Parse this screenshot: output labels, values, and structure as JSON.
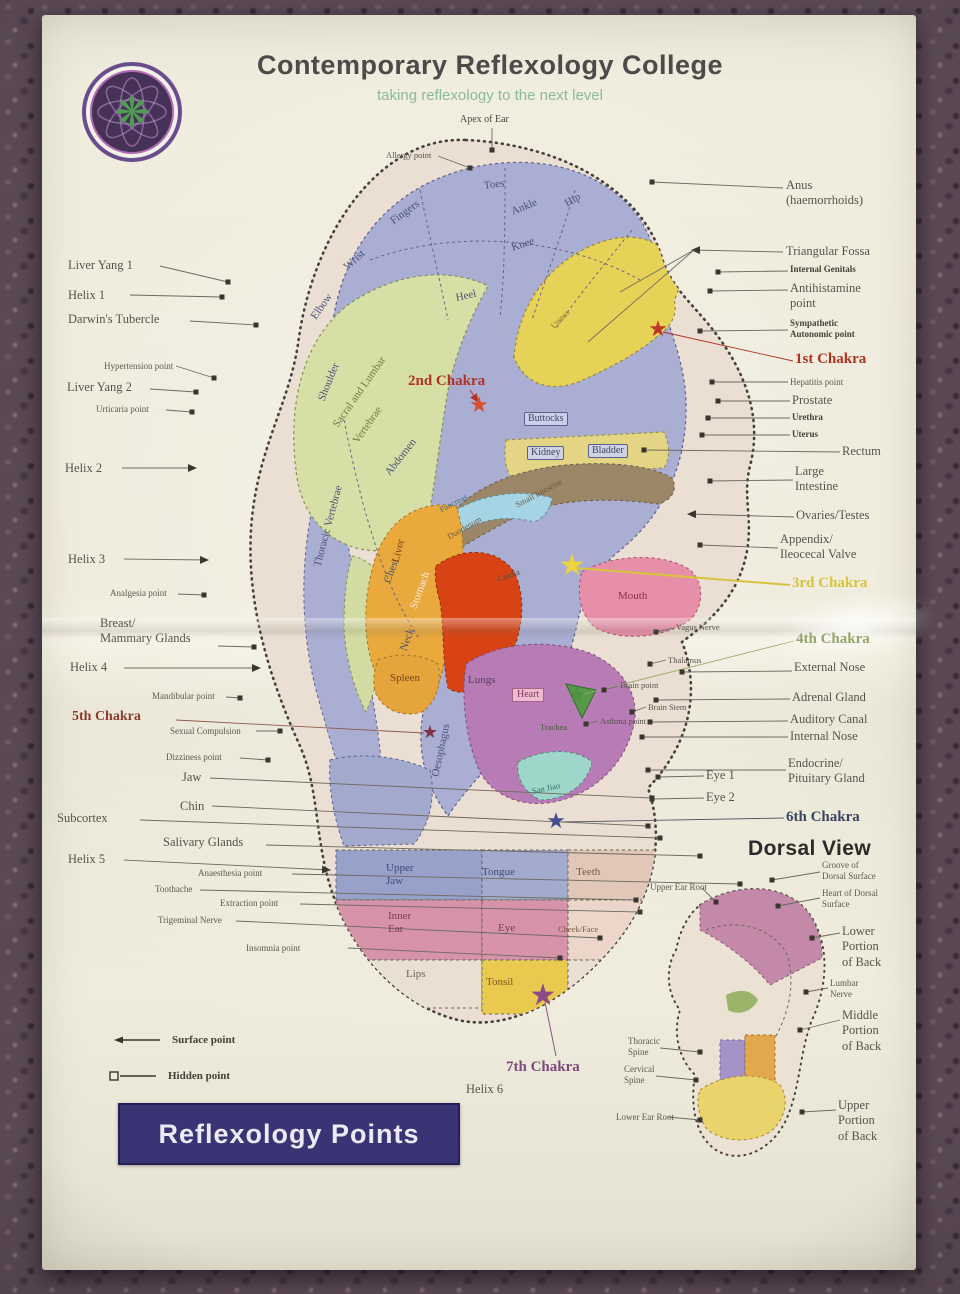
{
  "header": {
    "title": "Contemporary Reflexology College",
    "subtitle": "taking reflexology to the next level"
  },
  "banner": {
    "text": "Reflexology Points"
  },
  "legend": {
    "surface": "Surface point",
    "hidden": "Hidden point"
  },
  "colors": {
    "banner_bg": "#3a3474",
    "subtitle_green": "#8bbb94",
    "chakra_red": "#b23223",
    "chakra_yellow": "#d8c33c",
    "chakra_green": "#95a56b",
    "chakra_purple": "#7c4a7c",
    "chakra_maroon": "#8e3a2c",
    "chakra_indigo": "#3e4460"
  },
  "labels": [
    {
      "t": "Liver Yang 1",
      "x": 68,
      "y": 258,
      "s": "n",
      "ln": [
        160,
        266,
        228,
        282
      ],
      "m": "sq"
    },
    {
      "t": "Helix 1",
      "x": 68,
      "y": 288,
      "s": "n",
      "ln": [
        130,
        295,
        222,
        297
      ],
      "m": "sq"
    },
    {
      "t": "Darwin's Tubercle",
      "x": 68,
      "y": 312,
      "s": "n",
      "ln": [
        190,
        321,
        256,
        325
      ],
      "m": "sq"
    },
    {
      "t": "Hypertension point",
      "x": 104,
      "y": 361,
      "s": "s",
      "ln": [
        176,
        366,
        214,
        378
      ],
      "m": "sq"
    },
    {
      "t": "Liver Yang 2",
      "x": 67,
      "y": 380,
      "s": "n",
      "ln": [
        150,
        389,
        196,
        392
      ],
      "m": "sq"
    },
    {
      "t": "Urticaria point",
      "x": 96,
      "y": 404,
      "s": "s",
      "ln": [
        166,
        410,
        192,
        412
      ],
      "m": "sq"
    },
    {
      "t": "Helix 2",
      "x": 65,
      "y": 461,
      "s": "n",
      "ln": [
        122,
        468,
        196,
        468
      ],
      "m": "ar"
    },
    {
      "t": "Helix 3",
      "x": 68,
      "y": 552,
      "s": "n",
      "ln": [
        124,
        559,
        208,
        560
      ],
      "m": "ar"
    },
    {
      "t": "Analgesia point",
      "x": 110,
      "y": 588,
      "s": "s",
      "ln": [
        178,
        594,
        204,
        595
      ],
      "m": "sq"
    },
    {
      "t": "Breast/\nMammary Glands",
      "x": 100,
      "y": 616,
      "s": "n",
      "ln": [
        218,
        646,
        254,
        647
      ],
      "m": "sq"
    },
    {
      "t": "Helix 4",
      "x": 70,
      "y": 660,
      "s": "n",
      "ln": [
        124,
        668,
        260,
        668
      ],
      "m": "ar"
    },
    {
      "t": "Mandibular point",
      "x": 152,
      "y": 691,
      "s": "s",
      "ln": [
        226,
        697,
        240,
        698
      ],
      "m": "sq"
    },
    {
      "t": "5th Chakra",
      "x": 72,
      "y": 708,
      "s": "ch5",
      "ln": [
        176,
        720,
        424,
        733
      ],
      "lc": "#8e5a4c"
    },
    {
      "t": "Sexual Compulsion",
      "x": 170,
      "y": 726,
      "s": "s",
      "ln": [
        256,
        731,
        280,
        731
      ],
      "m": "sq"
    },
    {
      "t": "Dizziness point",
      "x": 166,
      "y": 752,
      "s": "s",
      "ln": [
        240,
        758,
        268,
        760
      ],
      "m": "sq"
    },
    {
      "t": "Jaw",
      "x": 182,
      "y": 770,
      "s": "n",
      "ln": [
        210,
        778,
        652,
        798
      ],
      "m": "sq"
    },
    {
      "t": "Chin",
      "x": 180,
      "y": 799,
      "s": "n",
      "ln": [
        212,
        806,
        648,
        826
      ],
      "m": "sq"
    },
    {
      "t": "Subcortex",
      "x": 57,
      "y": 811,
      "s": "n",
      "ln": [
        140,
        820,
        660,
        838
      ],
      "m": "sq"
    },
    {
      "t": "Salivary Glands",
      "x": 163,
      "y": 835,
      "s": "n",
      "ln": [
        266,
        845,
        700,
        856
      ],
      "m": "sq"
    },
    {
      "t": "Helix 5",
      "x": 68,
      "y": 852,
      "s": "n",
      "ln": [
        124,
        860,
        330,
        870
      ],
      "m": "ar"
    },
    {
      "t": "Anaesthesia point",
      "x": 198,
      "y": 868,
      "s": "s",
      "ln": [
        292,
        874,
        740,
        884
      ],
      "m": "sq"
    },
    {
      "t": "Toothache",
      "x": 155,
      "y": 884,
      "s": "s",
      "ln": [
        200,
        890,
        636,
        900
      ],
      "m": "sq"
    },
    {
      "t": "Extraction point",
      "x": 220,
      "y": 898,
      "s": "s",
      "ln": [
        300,
        904,
        640,
        912
      ],
      "m": "sq"
    },
    {
      "t": "Trigeminal Nerve",
      "x": 158,
      "y": 915,
      "s": "s",
      "ln": [
        236,
        921,
        600,
        938
      ],
      "m": "sq"
    },
    {
      "t": "Insomnia point",
      "x": 246,
      "y": 943,
      "s": "s",
      "ln": [
        348,
        948,
        560,
        958
      ],
      "m": "sq"
    },
    {
      "t": "Anus\n(haemorrhoids)",
      "x": 786,
      "y": 178,
      "s": "n",
      "ln": [
        783,
        188,
        652,
        182
      ],
      "m": "sq"
    },
    {
      "t": "Triangular Fossa",
      "x": 786,
      "y": 244,
      "s": "n",
      "ln": [
        783,
        252,
        692,
        250
      ],
      "m": "ar"
    },
    {
      "t": "Internal Genitals",
      "x": 790,
      "y": 264,
      "s": "b",
      "ln": [
        788,
        271,
        718,
        272
      ],
      "m": "sq"
    },
    {
      "t": "Antihistamine\npoint",
      "x": 790,
      "y": 281,
      "s": "n",
      "ln": [
        788,
        290,
        710,
        291
      ],
      "m": "sq"
    },
    {
      "t": "Sympathetic\nAutonomic point",
      "x": 790,
      "y": 318,
      "s": "b",
      "ln": [
        788,
        330,
        700,
        331
      ],
      "m": "sq"
    },
    {
      "t": "1st Chakra",
      "x": 795,
      "y": 350,
      "s": "ch1",
      "ln": [
        793,
        361,
        663,
        332
      ],
      "lc": "#b23223"
    },
    {
      "t": "Hepatitis point",
      "x": 790,
      "y": 377,
      "s": "s",
      "ln": [
        788,
        382,
        712,
        382
      ],
      "m": "sq"
    },
    {
      "t": "Prostate",
      "x": 792,
      "y": 393,
      "s": "n",
      "ln": [
        790,
        401,
        718,
        401
      ],
      "m": "sq"
    },
    {
      "t": "Urethra",
      "x": 792,
      "y": 412,
      "s": "b",
      "ln": [
        790,
        418,
        708,
        418
      ],
      "m": "sq"
    },
    {
      "t": "Uterus",
      "x": 792,
      "y": 429,
      "s": "b",
      "ln": [
        790,
        435,
        702,
        435
      ],
      "m": "sq"
    },
    {
      "t": "Rectum",
      "x": 842,
      "y": 444,
      "s": "n",
      "ln": [
        840,
        452,
        644,
        450
      ],
      "m": "sq"
    },
    {
      "t": "Large\nIntestine",
      "x": 795,
      "y": 464,
      "s": "n",
      "ln": [
        793,
        480,
        710,
        481
      ],
      "m": "sq"
    },
    {
      "t": "Ovaries/Testes",
      "x": 796,
      "y": 508,
      "s": "n",
      "ln": [
        794,
        517,
        688,
        514
      ],
      "m": "ar"
    },
    {
      "t": "Appendix/\nIleocecal Valve",
      "x": 780,
      "y": 532,
      "s": "n",
      "ln": [
        778,
        548,
        700,
        545
      ],
      "m": "sq"
    },
    {
      "t": "3rd Chakra",
      "x": 792,
      "y": 574,
      "s": "ch3",
      "ln": [
        790,
        585,
        576,
        568
      ],
      "lc": "#d8c33c",
      "w": 2
    },
    {
      "t": "4th Chakra",
      "x": 796,
      "y": 630,
      "s": "ch4",
      "ln": [
        794,
        641,
        584,
        694
      ],
      "lc": "#9aa86e"
    },
    {
      "t": "External Nose",
      "x": 794,
      "y": 660,
      "s": "n",
      "ln": [
        792,
        671,
        682,
        672
      ],
      "m": "sq"
    },
    {
      "t": "Adrenal Gland",
      "x": 792,
      "y": 690,
      "s": "n",
      "ln": [
        790,
        699,
        656,
        700
      ],
      "m": "sq"
    },
    {
      "t": "Auditory Canal",
      "x": 790,
      "y": 712,
      "s": "n",
      "ln": [
        788,
        721,
        650,
        722
      ],
      "m": "sq"
    },
    {
      "t": "Internal Nose",
      "x": 790,
      "y": 729,
      "s": "n",
      "ln": [
        788,
        737,
        642,
        737
      ],
      "m": "sq"
    },
    {
      "t": "Endocrine/\nPituitary Gland",
      "x": 788,
      "y": 756,
      "s": "n",
      "ln": [
        786,
        770,
        648,
        770
      ],
      "m": "sq"
    },
    {
      "t": "Eye 1",
      "x": 706,
      "y": 768,
      "s": "n",
      "ln": [
        704,
        776,
        658,
        777
      ],
      "m": "sq"
    },
    {
      "t": "Eye 2",
      "x": 706,
      "y": 790,
      "s": "n",
      "ln": [
        704,
        798,
        652,
        799
      ],
      "m": "sq"
    },
    {
      "t": "6th Chakra",
      "x": 786,
      "y": 808,
      "s": "ch6",
      "ln": [
        784,
        818,
        562,
        822
      ],
      "lc": "#55566a"
    },
    {
      "t": "Dorsal View",
      "x": 748,
      "y": 836,
      "s": "h",
      "n": "dorsal-view-title"
    },
    {
      "t": "Groove of\nDorsal Surface",
      "x": 822,
      "y": 860,
      "s": "s",
      "ln": [
        820,
        872,
        772,
        880
      ],
      "m": "sq"
    },
    {
      "t": "Heart of Dorsal\nSurface",
      "x": 822,
      "y": 888,
      "s": "s",
      "ln": [
        820,
        898,
        778,
        906
      ],
      "m": "sq"
    },
    {
      "t": "Lower\nPortion\nof Back",
      "x": 842,
      "y": 924,
      "s": "n",
      "ln": [
        840,
        933,
        812,
        938
      ],
      "m": "sq"
    },
    {
      "t": "Lumbar\nNerve",
      "x": 830,
      "y": 978,
      "s": "s",
      "ln": [
        828,
        988,
        806,
        992
      ],
      "m": "sq"
    },
    {
      "t": "Middle\nPortion\nof Back",
      "x": 842,
      "y": 1008,
      "s": "n",
      "ln": [
        840,
        1020,
        800,
        1030
      ],
      "m": "sq"
    },
    {
      "t": "Upper\nPortion\nof Back",
      "x": 838,
      "y": 1098,
      "s": "n",
      "ln": [
        836,
        1110,
        802,
        1112
      ],
      "m": "sq"
    },
    {
      "t": "Upper Ear Root",
      "x": 650,
      "y": 882,
      "s": "s",
      "ln": [
        702,
        888,
        716,
        902
      ],
      "m": "sq"
    },
    {
      "t": "Thoracic\nSpine",
      "x": 628,
      "y": 1036,
      "s": "s",
      "ln": [
        660,
        1048,
        700,
        1052
      ],
      "m": "sq"
    },
    {
      "t": "Cervical\nSpine",
      "x": 624,
      "y": 1064,
      "s": "s",
      "ln": [
        656,
        1076,
        696,
        1080
      ],
      "m": "sq"
    },
    {
      "t": "Lower Ear Root",
      "x": 616,
      "y": 1112,
      "s": "s",
      "ln": [
        668,
        1117,
        700,
        1120
      ],
      "m": "sq"
    },
    {
      "t": "Apex of Ear",
      "x": 460,
      "y": 114,
      "s": "cap",
      "ln": [
        492,
        128,
        492,
        150
      ],
      "m": "sq"
    },
    {
      "t": "Allergy point",
      "x": 386,
      "y": 150,
      "s": "ints",
      "ln": [
        438,
        156,
        470,
        168
      ],
      "m": "sq"
    },
    {
      "t": "Toes",
      "x": 484,
      "y": 180,
      "s": "int",
      "r": -8
    },
    {
      "t": "Ankle",
      "x": 512,
      "y": 206,
      "s": "int",
      "r": -22
    },
    {
      "t": "Knee",
      "x": 512,
      "y": 242,
      "s": "int",
      "r": -18
    },
    {
      "t": "Hip",
      "x": 566,
      "y": 198,
      "s": "int",
      "r": -30
    },
    {
      "t": "Fingers",
      "x": 392,
      "y": 216,
      "s": "int",
      "r": -36
    },
    {
      "t": "Wrist",
      "x": 346,
      "y": 262,
      "s": "int",
      "r": -42
    },
    {
      "t": "Elbow",
      "x": 314,
      "y": 312,
      "s": "int",
      "r": -55
    },
    {
      "t": "Shoulder",
      "x": 322,
      "y": 394,
      "s": "int",
      "r": -68
    },
    {
      "t": "Heel",
      "x": 456,
      "y": 292,
      "s": "int",
      "r": -12
    },
    {
      "t": "Sacral and Lumbar",
      "x": 336,
      "y": 420,
      "s": "int",
      "r": -55,
      "c": "#6f7b42"
    },
    {
      "t": "Vertebrae",
      "x": 356,
      "y": 436,
      "s": "int",
      "r": -55,
      "c": "#6f7b42"
    },
    {
      "t": "Thoracic Vertebrae",
      "x": 318,
      "y": 560,
      "s": "int",
      "r": -75,
      "c": "#4c5178"
    },
    {
      "t": "Chest",
      "x": 388,
      "y": 576,
      "s": "int",
      "r": -70
    },
    {
      "t": "Neck",
      "x": 404,
      "y": 644,
      "s": "int",
      "r": -70
    },
    {
      "t": "2nd Chakra",
      "x": 408,
      "y": 372,
      "s": "ch2",
      "ln": [
        470,
        390,
        478,
        402
      ],
      "lc": "#b23223",
      "m": "arr"
    },
    {
      "t": "Buttocks",
      "x": 524,
      "y": 412,
      "s": "box"
    },
    {
      "t": "Kidney",
      "x": 527,
      "y": 446,
      "s": "box"
    },
    {
      "t": "Bladder",
      "x": 588,
      "y": 444,
      "s": "box"
    },
    {
      "t": "Uterus",
      "x": 552,
      "y": 322,
      "s": "ints",
      "r": -45,
      "c": "#8a7a2e"
    },
    {
      "t": "Abdomen",
      "x": 388,
      "y": 468,
      "s": "int",
      "r": -52
    },
    {
      "t": "Pancreas",
      "x": 440,
      "y": 505,
      "s": "ints",
      "r": -28,
      "c": "#3e6e80"
    },
    {
      "t": "Duodenum",
      "x": 448,
      "y": 532,
      "s": "ints",
      "r": -30,
      "c": "#6e5a3a"
    },
    {
      "t": "Liver",
      "x": 396,
      "y": 556,
      "s": "int",
      "r": -75,
      "c": "#7a4416"
    },
    {
      "t": "Stomach",
      "x": 414,
      "y": 602,
      "s": "int",
      "r": -70,
      "c": "#fbe9dd"
    },
    {
      "t": "Cardia",
      "x": 498,
      "y": 574,
      "s": "ints",
      "r": -20,
      "c": "#5a4a3a"
    },
    {
      "t": "Small Intestine",
      "x": 516,
      "y": 500,
      "s": "ints",
      "r": -28,
      "c": "#6e5a3a"
    },
    {
      "t": "Mouth",
      "x": 618,
      "y": 590,
      "s": "int",
      "c": "#8a3050"
    },
    {
      "t": "Spleen",
      "x": 390,
      "y": 672,
      "s": "int",
      "c": "#7a4416"
    },
    {
      "t": "Lungs",
      "x": 468,
      "y": 674,
      "s": "int",
      "c": "#5e3a60"
    },
    {
      "t": "Heart",
      "x": 512,
      "y": 688,
      "s": "boxp"
    },
    {
      "t": "Trachea",
      "x": 540,
      "y": 722,
      "s": "ints",
      "c": "#4a5a3e"
    },
    {
      "t": "Oesophagus",
      "x": 436,
      "y": 770,
      "s": "int",
      "r": -78
    },
    {
      "t": "San Jiao",
      "x": 532,
      "y": 786,
      "s": "ints",
      "r": -12,
      "c": "#2e6e62"
    },
    {
      "t": "Vagus Nerve",
      "x": 676,
      "y": 622,
      "s": "ints",
      "ln": [
        674,
        628,
        656,
        632
      ],
      "m": "sq"
    },
    {
      "t": "Thalamus",
      "x": 668,
      "y": 655,
      "s": "ints",
      "ln": [
        666,
        660,
        650,
        664
      ],
      "m": "sq"
    },
    {
      "t": "Brain point",
      "x": 620,
      "y": 680,
      "s": "ints",
      "ln": [
        618,
        686,
        604,
        690
      ],
      "m": "sq"
    },
    {
      "t": "Brain Stem",
      "x": 648,
      "y": 702,
      "s": "ints",
      "ln": [
        646,
        707,
        632,
        712
      ],
      "m": "sq"
    },
    {
      "t": "Asthma point",
      "x": 600,
      "y": 716,
      "s": "ints",
      "ln": [
        598,
        721,
        586,
        724
      ],
      "m": "sq"
    },
    {
      "t": "Upper\nJaw",
      "x": 386,
      "y": 862,
      "s": "int",
      "c": "#3e4a7a"
    },
    {
      "t": "Tongue",
      "x": 482,
      "y": 866,
      "s": "int",
      "c": "#3e4a7a"
    },
    {
      "t": "Teeth",
      "x": 576,
      "y": 866,
      "s": "int",
      "c": "#7a5a42"
    },
    {
      "t": "Inner\nEar",
      "x": 388,
      "y": 910,
      "s": "int",
      "c": "#7c3a5a"
    },
    {
      "t": "Eye",
      "x": 498,
      "y": 922,
      "s": "int",
      "c": "#7c3a5a"
    },
    {
      "t": "Cheek/Face",
      "x": 558,
      "y": 924,
      "s": "ints",
      "c": "#7a5a42"
    },
    {
      "t": "Lips",
      "x": 406,
      "y": 968,
      "s": "int",
      "c": "#6a6258"
    },
    {
      "t": "Tonsil",
      "x": 486,
      "y": 976,
      "s": "int",
      "c": "#7a5a20"
    },
    {
      "t": "7th Chakra",
      "x": 506,
      "y": 1058,
      "s": "ch7",
      "ln": [
        545,
        1002,
        556,
        1056
      ],
      "lc": "#7c4a7c"
    },
    {
      "t": "Helix 6",
      "x": 466,
      "y": 1082,
      "s": "n"
    }
  ],
  "extra_lines": [
    {
      "ln": [
        620,
        292,
        694,
        250
      ]
    },
    {
      "ln": [
        588,
        342,
        694,
        250
      ]
    }
  ],
  "stars": [
    {
      "name": "1st-chakra-star",
      "x": 658,
      "y": 330,
      "size": 22,
      "color": "#bf3527"
    },
    {
      "name": "2nd-chakra-star",
      "x": 479,
      "y": 406,
      "size": 22,
      "color": "#d4502e"
    },
    {
      "name": "3rd-chakra-star",
      "x": 572,
      "y": 566,
      "size": 30,
      "color": "#ecd23c"
    },
    {
      "name": "4th-chakra-star",
      "x": 577,
      "y": 696,
      "size": 22,
      "color": "#4e9140"
    },
    {
      "name": "5th-chakra-star",
      "x": 430,
      "y": 733,
      "size": 18,
      "color": "#7e3344"
    },
    {
      "name": "6th-chakra-star",
      "x": 556,
      "y": 822,
      "size": 22,
      "color": "#46508e"
    },
    {
      "name": "7th-chakra-star",
      "x": 543,
      "y": 996,
      "size": 30,
      "color": "#8c4a86"
    }
  ]
}
